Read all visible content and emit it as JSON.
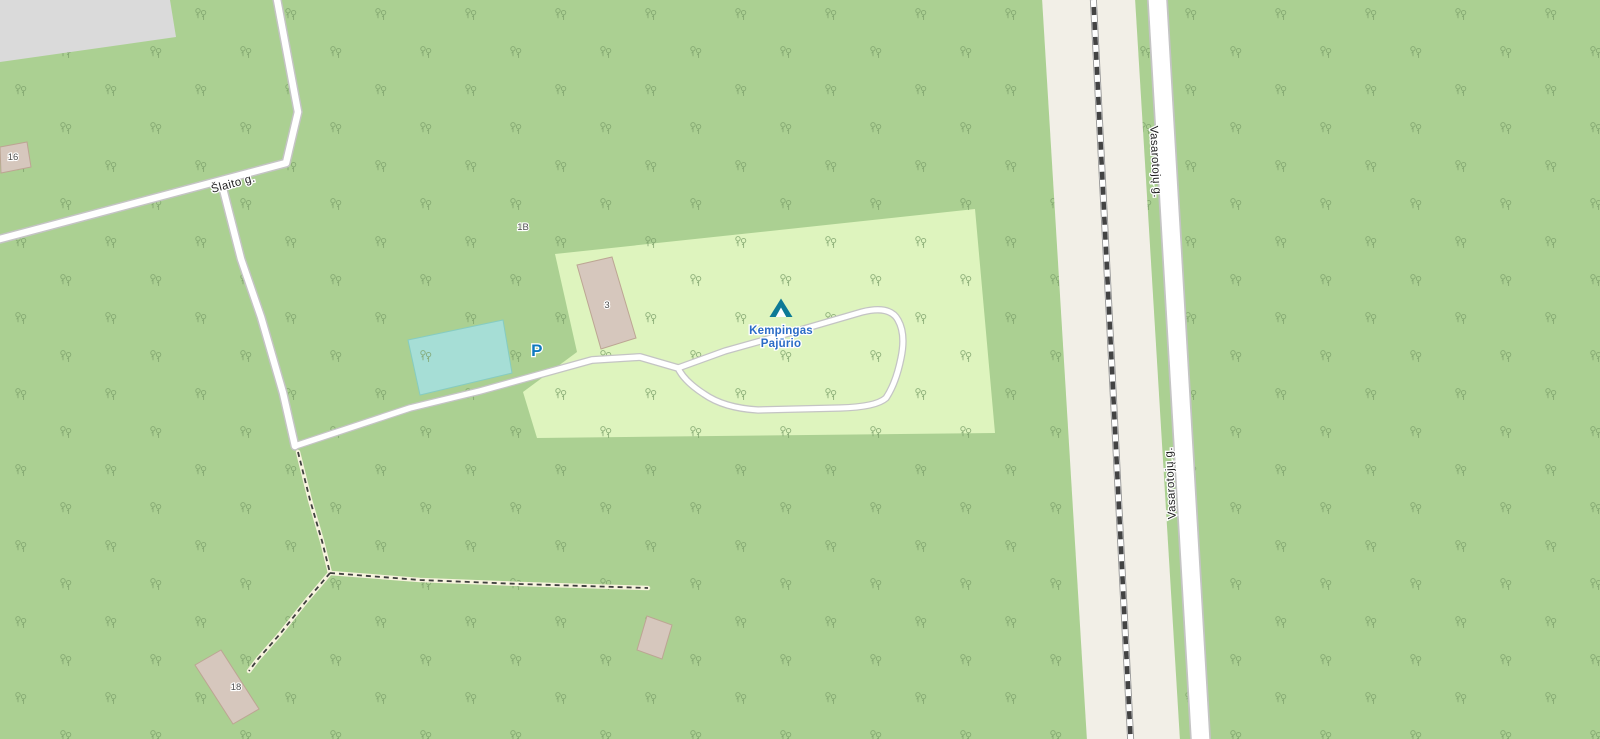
{
  "colors": {
    "forest-green": "#abd092",
    "campsite-green": "#def4be",
    "land-beige": "#f2efe7",
    "teal-fill": "#a6ded6",
    "teal-stroke": "#86ccc1",
    "gray-fill": "#dadada",
    "building-fill": "#d6c7bd",
    "building-stroke": "#bca593",
    "road-fill": "#ffffff",
    "road-casing": "#c4c4c4",
    "rail-base": "#979797",
    "rail-dark": "#434343",
    "path-casing": "#f7f3de",
    "path-dash": "#3e3e3e",
    "tree-green": "#7ea26c",
    "street-label": "#1e1e1e",
    "label-halo": "#ffffff",
    "housenumber-text": "#4f4f4f",
    "campsite-blue": "#2b6cc6",
    "tent-teal": "#0d7a96",
    "parking-blue": "#0e79c0"
  },
  "labels": {
    "street_slaito": "Šlaito g.",
    "street_vasarotoju": "Vasarotojų g.",
    "campsite_name_line1": "Kempingas",
    "campsite_name_line2": "Pajūrio",
    "parking_symbol": "P"
  },
  "house_numbers": {
    "building_16": "16",
    "building_1b": "1B",
    "building_3": "3",
    "building_18": "18"
  }
}
